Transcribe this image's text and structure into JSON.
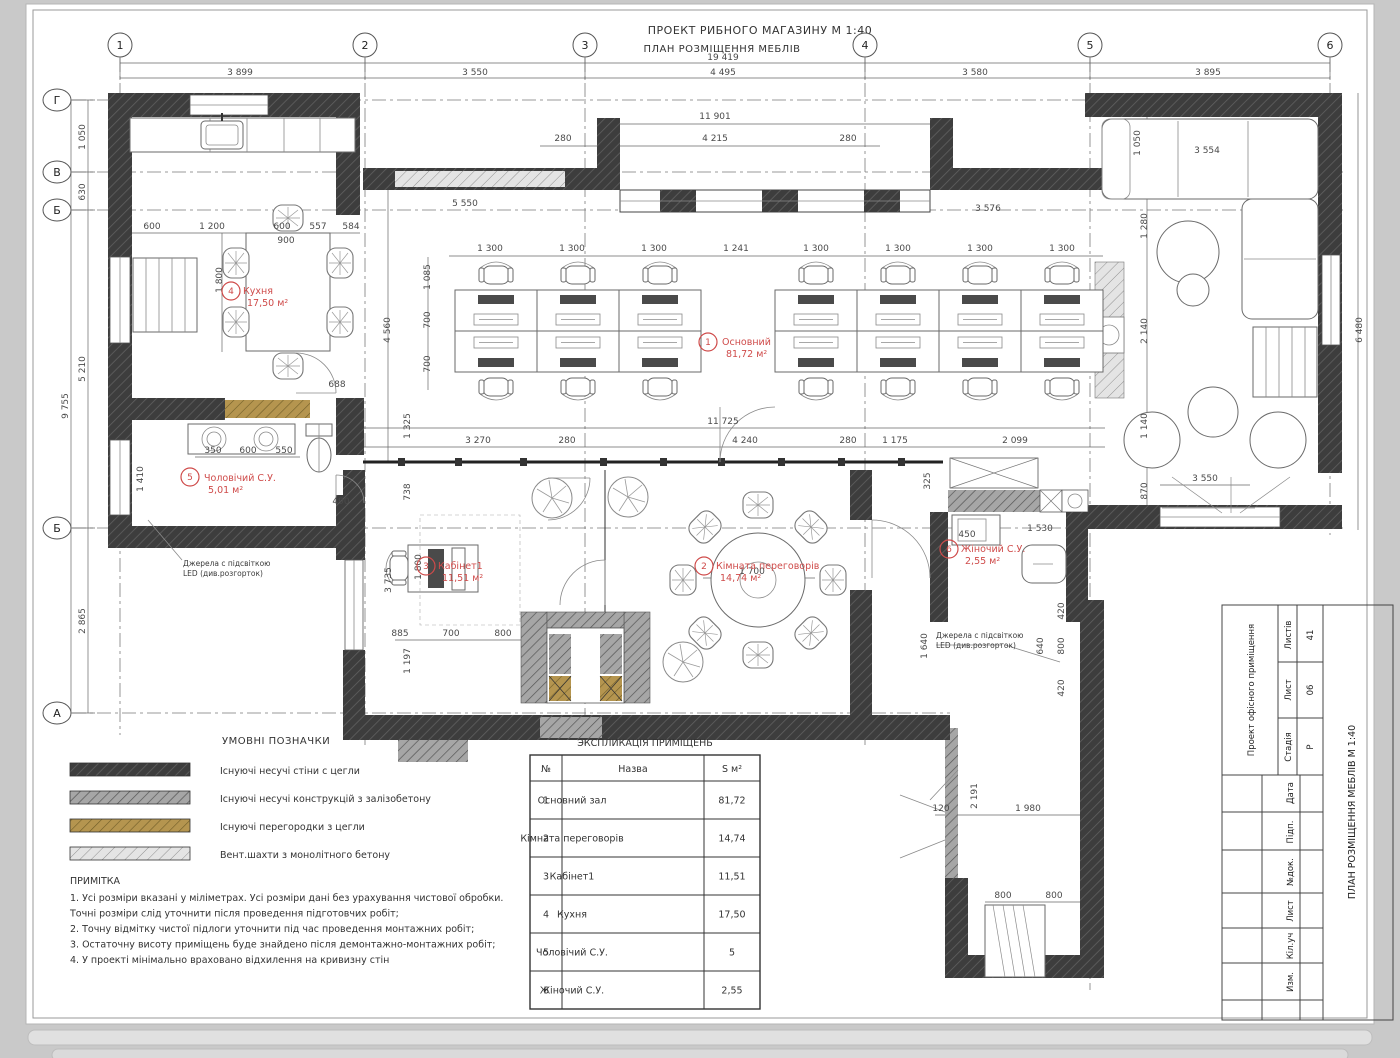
{
  "header": {
    "line1": "ПРОЕКТ РИБНОГО МАГАЗИНУ  М 1:40",
    "line2": "ПЛАН РОЗМІЩЕННЯ МЕБЛІВ"
  },
  "axes": {
    "cols": [
      {
        "label": "1",
        "x": 120
      },
      {
        "label": "2",
        "x": 365
      },
      {
        "label": "3",
        "x": 585
      },
      {
        "label": "4",
        "x": 865
      },
      {
        "label": "5",
        "x": 1090
      },
      {
        "label": "6",
        "x": 1330
      }
    ],
    "rows": [
      {
        "label": "Г",
        "y": 100
      },
      {
        "label": "В",
        "y": 172
      },
      {
        "label": "Б",
        "y": 210
      },
      {
        "label": "Б",
        "y": 528
      },
      {
        "label": "А",
        "y": 713
      }
    ]
  },
  "dims": [
    {
      "x": 240,
      "y": 75,
      "t": "3 899"
    },
    {
      "x": 475,
      "y": 75,
      "t": "3 550"
    },
    {
      "x": 723,
      "y": 75,
      "t": "4 495"
    },
    {
      "x": 975,
      "y": 75,
      "t": "3 580"
    },
    {
      "x": 1208,
      "y": 75,
      "t": "3 895"
    },
    {
      "x": 723,
      "y": 60,
      "t": "19 419"
    },
    {
      "x": 715,
      "y": 119,
      "t": "11 901"
    },
    {
      "x": 563,
      "y": 141,
      "t": "280"
    },
    {
      "x": 715,
      "y": 141,
      "t": "4 215"
    },
    {
      "x": 848,
      "y": 141,
      "t": "280"
    },
    {
      "x": 1207,
      "y": 153,
      "t": "3 554"
    },
    {
      "x": 1140,
      "y": 143,
      "t": "1 050",
      "r": 1
    },
    {
      "x": 152,
      "y": 229,
      "t": "600"
    },
    {
      "x": 212,
      "y": 229,
      "t": "1 200"
    },
    {
      "x": 282,
      "y": 229,
      "t": "600"
    },
    {
      "x": 318,
      "y": 229,
      "t": "557"
    },
    {
      "x": 351,
      "y": 229,
      "t": "584"
    },
    {
      "x": 465,
      "y": 206,
      "t": "5 550"
    },
    {
      "x": 988,
      "y": 211,
      "t": "3 576"
    },
    {
      "x": 286,
      "y": 243,
      "t": "900"
    },
    {
      "x": 222,
      "y": 280,
      "t": "1 800",
      "r": 1
    },
    {
      "x": 337,
      "y": 387,
      "t": "688"
    },
    {
      "x": 490,
      "y": 251,
      "t": "1 300"
    },
    {
      "x": 572,
      "y": 251,
      "t": "1 300"
    },
    {
      "x": 654,
      "y": 251,
      "t": "1 300"
    },
    {
      "x": 736,
      "y": 251,
      "t": "1 241"
    },
    {
      "x": 816,
      "y": 251,
      "t": "1 300"
    },
    {
      "x": 898,
      "y": 251,
      "t": "1 300"
    },
    {
      "x": 980,
      "y": 251,
      "t": "1 300"
    },
    {
      "x": 1062,
      "y": 251,
      "t": "1 300"
    },
    {
      "x": 430,
      "y": 277,
      "t": "1 085",
      "r": 1
    },
    {
      "x": 430,
      "y": 320,
      "t": "700",
      "r": 1
    },
    {
      "x": 430,
      "y": 364,
      "t": "700",
      "r": 1
    },
    {
      "x": 390,
      "y": 330,
      "t": "4 560",
      "r": 1
    },
    {
      "x": 410,
      "y": 426,
      "t": "1 325",
      "r": 1
    },
    {
      "x": 723,
      "y": 424,
      "t": "11 725"
    },
    {
      "x": 478,
      "y": 443,
      "t": "3 270"
    },
    {
      "x": 567,
      "y": 443,
      "t": "280"
    },
    {
      "x": 745,
      "y": 443,
      "t": "4 240"
    },
    {
      "x": 848,
      "y": 443,
      "t": "280"
    },
    {
      "x": 895,
      "y": 443,
      "t": "1 175"
    },
    {
      "x": 1015,
      "y": 443,
      "t": "2 099"
    },
    {
      "x": 213,
      "y": 453,
      "t": "350"
    },
    {
      "x": 248,
      "y": 453,
      "t": "600"
    },
    {
      "x": 284,
      "y": 453,
      "t": "550"
    },
    {
      "x": 143,
      "y": 479,
      "t": "1 410",
      "r": 1
    },
    {
      "x": 341,
      "y": 504,
      "t": "490"
    },
    {
      "x": 410,
      "y": 492,
      "t": "738",
      "r": 1
    },
    {
      "x": 391,
      "y": 580,
      "t": "3 735",
      "r": 1
    },
    {
      "x": 421,
      "y": 567,
      "t": "1 800",
      "r": 1
    },
    {
      "x": 400,
      "y": 636,
      "t": "885"
    },
    {
      "x": 451,
      "y": 636,
      "t": "700"
    },
    {
      "x": 503,
      "y": 636,
      "t": "800"
    },
    {
      "x": 410,
      "y": 661,
      "t": "1 197",
      "r": 1
    },
    {
      "x": 752,
      "y": 574,
      "t": "1 700"
    },
    {
      "x": 930,
      "y": 481,
      "t": "325",
      "r": 1
    },
    {
      "x": 967,
      "y": 537,
      "t": "450"
    },
    {
      "x": 1040,
      "y": 531,
      "t": "1 530"
    },
    {
      "x": 927,
      "y": 646,
      "t": "1 640",
      "r": 1
    },
    {
      "x": 1043,
      "y": 646,
      "t": "640",
      "r": 1
    },
    {
      "x": 1064,
      "y": 611,
      "t": "420",
      "r": 1
    },
    {
      "x": 1064,
      "y": 646,
      "t": "800",
      "r": 1
    },
    {
      "x": 1064,
      "y": 688,
      "t": "420",
      "r": 1
    },
    {
      "x": 1147,
      "y": 226,
      "t": "1 280",
      "r": 1
    },
    {
      "x": 1147,
      "y": 331,
      "t": "2 140",
      "r": 1
    },
    {
      "x": 1147,
      "y": 426,
      "t": "1 140",
      "r": 1
    },
    {
      "x": 1147,
      "y": 491,
      "t": "870",
      "r": 1
    },
    {
      "x": 1205,
      "y": 481,
      "t": "3 550"
    },
    {
      "x": 1362,
      "y": 330,
      "t": "6 480",
      "r": 1
    },
    {
      "x": 941,
      "y": 811,
      "t": "120"
    },
    {
      "x": 977,
      "y": 796,
      "t": "2 191",
      "r": 1
    },
    {
      "x": 1028,
      "y": 811,
      "t": "1 980"
    },
    {
      "x": 1003,
      "y": 898,
      "t": "800"
    },
    {
      "x": 1054,
      "y": 898,
      "t": "800"
    },
    {
      "x": 85,
      "y": 137,
      "t": "1 050",
      "r": 1
    },
    {
      "x": 85,
      "y": 192,
      "t": "630",
      "r": 1
    },
    {
      "x": 85,
      "y": 369,
      "t": "5 210",
      "r": 1
    },
    {
      "x": 85,
      "y": 621,
      "t": "2 865",
      "r": 1
    },
    {
      "x": 68,
      "y": 406,
      "t": "9 755",
      "r": 1
    }
  ],
  "rooms": [
    {
      "num": "1",
      "cx": 708,
      "cy": 342,
      "name": "Основний",
      "area": "81,72 м²",
      "tx": 722,
      "ty": 345
    },
    {
      "num": "2",
      "cx": 704,
      "cy": 566,
      "name": "Кімната переговорів",
      "area": "14,74 м²",
      "tx": 716,
      "ty": 569
    },
    {
      "num": "3",
      "cx": 426,
      "cy": 566,
      "name": "Кабінет1",
      "area": "11,51 м²",
      "tx": 438,
      "ty": 569
    },
    {
      "num": "4",
      "cx": 231,
      "cy": 291,
      "name": "Кухня",
      "area": "17,50 м²",
      "tx": 243,
      "ty": 294
    },
    {
      "num": "5",
      "cx": 190,
      "cy": 477,
      "name": "Чоловічий С.У.",
      "area": "5,01 м²",
      "tx": 204,
      "ty": 481
    },
    {
      "num": "6",
      "cx": 949,
      "cy": 549,
      "name": "Жіночий С.У.",
      "area": "2,55 м²",
      "tx": 961,
      "ty": 552
    }
  ],
  "annotations": [
    {
      "x": 183,
      "y": 566,
      "lines": [
        "Джерела с підсвіткою",
        "LED (див.розгорток)"
      ]
    },
    {
      "x": 936,
      "y": 638,
      "lines": [
        "Джерела с підсвіткою",
        "LED (див.розгорток)"
      ]
    }
  ],
  "legend": {
    "title": "УМОВНІ ПОЗНАЧКИ",
    "items": [
      {
        "label": "Існуючі несучі стіни с цегли",
        "swatch": "dark"
      },
      {
        "label": "Існуючі несучі конструкцій з залізобетону",
        "swatch": "concrete"
      },
      {
        "label": "Існуючі перегородки з цегли",
        "swatch": "brick-partition"
      },
      {
        "label": "Вент.шахти з монолітного бетону",
        "swatch": "vent"
      }
    ],
    "colors": {
      "dark": "#3d3d3d",
      "concrete": "#9f9f9f",
      "brick-partition": "#b5954f",
      "vent": "#e2e2e2"
    }
  },
  "notes": {
    "title": "ПРИМІТКА",
    "lines": [
      "1. Усі розміри вказані у міліметрах. Усі розміри дані без урахування чистової обробки.",
      "Точні розміри слід уточнити після проведення підготовчих робіт;",
      "2. Точну відмітку чистої підлоги уточнити під час проведення монтажних робіт;",
      "3. Остаточну висоту приміщень буде знайдено після демонтажно-монтажних робіт;",
      "4. У проекті мінімально враховано відхилення на кривизну стін"
    ]
  },
  "table": {
    "title": "ЭКСПЛИКАЦІЯ ПРИМІЩЕНЬ",
    "headers": [
      "№",
      "Назва",
      "S м²"
    ],
    "rows": [
      [
        "1",
        "Основний зал",
        "81,72"
      ],
      [
        "2",
        "Кімната переговорів",
        "14,74"
      ],
      [
        "3",
        "Кабінет1",
        "11,51"
      ],
      [
        "4",
        "Кухня",
        "17,50"
      ],
      [
        "5",
        "Чоловічий С.У.",
        "5"
      ],
      [
        "6",
        "Жіночий С.У.",
        "2,55"
      ]
    ]
  },
  "titleblock": {
    "project": "Проект офісного приміщення",
    "sheet_title": "ПЛАН РОЗМІЩЕННЯ МЕБЛІВ  М 1:40",
    "cells": [
      {
        "label": "Листів",
        "value": "41"
      },
      {
        "label": "Лист",
        "value": "06"
      },
      {
        "label": "Стадія",
        "value": "Р"
      }
    ],
    "row_labels": [
      "Дата",
      "Підп.",
      "№док.",
      "Лист",
      "Кіл.уч",
      "Изм."
    ]
  }
}
